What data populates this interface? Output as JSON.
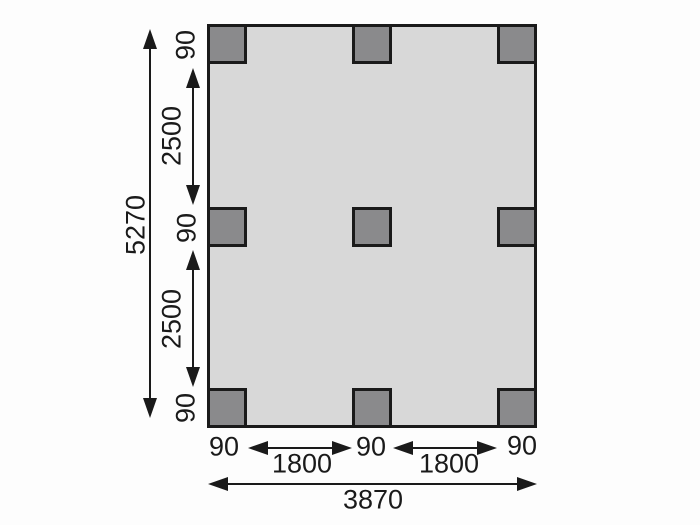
{
  "figure": {
    "type": "foundation-post-layout-plan",
    "colors": {
      "background": "#fdfdfd",
      "plan_fill": "#d8d8d8",
      "post_fill": "#8a8a8c",
      "line": "#1a1a1a"
    }
  },
  "dims": {
    "overall_height": "5270",
    "overall_width": "3870",
    "left_segments": [
      "90",
      "2500",
      "90",
      "2500",
      "90"
    ],
    "bottom_segments": [
      "90",
      "1800",
      "90",
      "1800",
      "90"
    ]
  }
}
